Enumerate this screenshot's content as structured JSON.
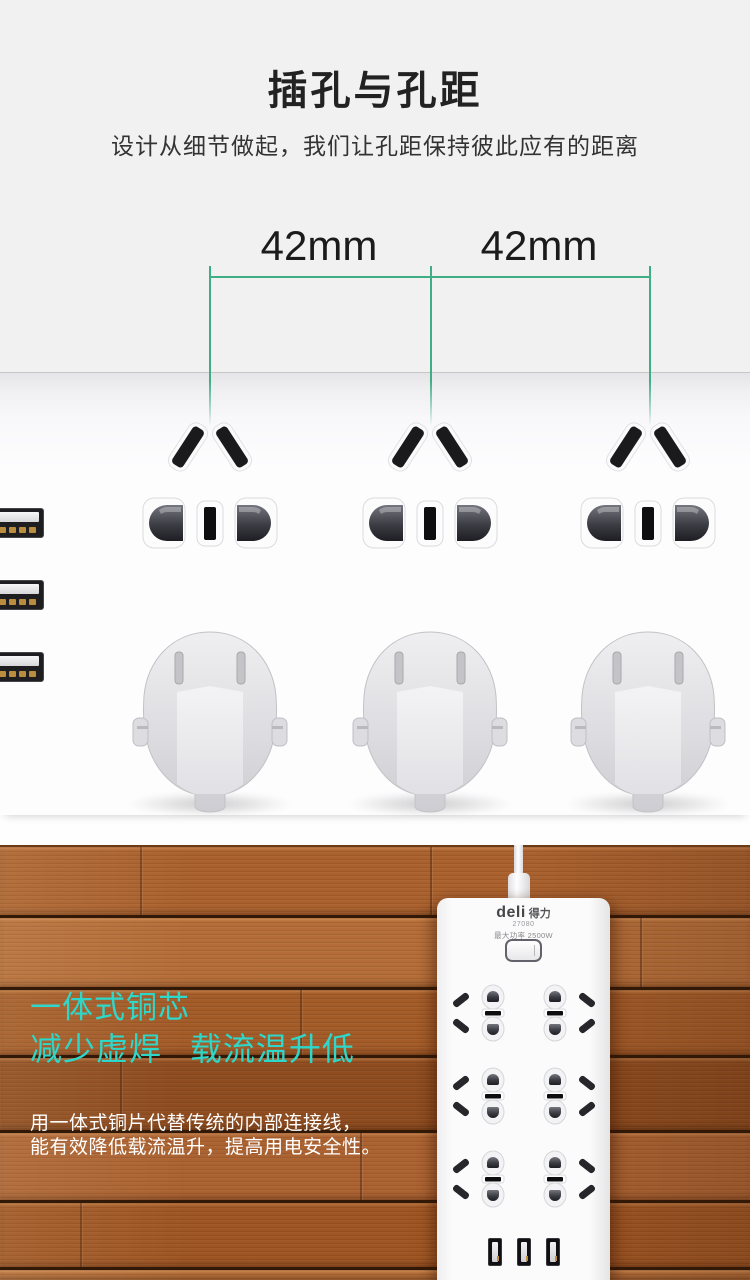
{
  "section_spacing": {
    "title": "插孔与孔距",
    "subtitle": "设计从细节做起，我们让孔距保持彼此应有的距离",
    "dimension_left": "42mm",
    "dimension_right": "42mm",
    "line_color": "#3fae85"
  },
  "device": {
    "brand": "deli",
    "brand_cn": "得力",
    "model": "27080",
    "max_power": "最大功率 2500W"
  },
  "section_copper": {
    "headline_line1": "一体式铜芯",
    "headline_line2": "减少虚焊 载流温升低",
    "headline_color": "#2dd8ca",
    "body_line1": "用一体式铜片代替传统的内部连接线，",
    "body_line2": "能有效降低载流温升，提高用电安全性。"
  },
  "graphics": {
    "top_socket_count": 3,
    "plug_count": 3,
    "side_usb_count": 3,
    "strip_socket_rows": 3,
    "strip_socket_cols": 2,
    "strip_usb_count": 3
  }
}
